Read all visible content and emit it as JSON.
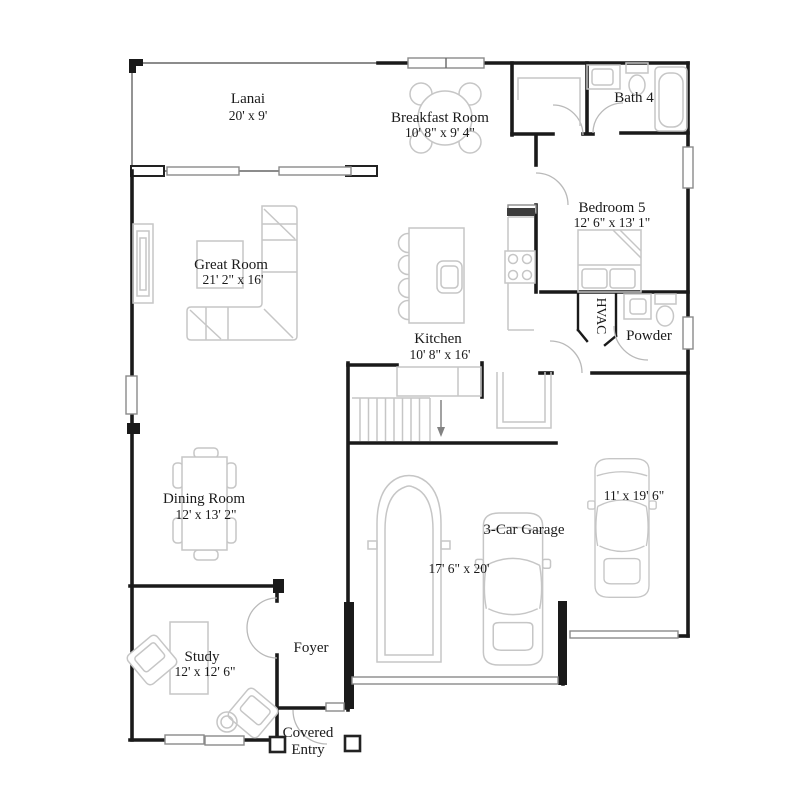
{
  "page": {
    "title": "First Floor Plan"
  },
  "colors": {
    "wall": "#1a1a1a",
    "furniture": "#c6c6c6",
    "text": "#1a1a1a",
    "background": "#ffffff"
  },
  "rooms": {
    "lanai": {
      "name": "Lanai",
      "dims": "20' x 9'"
    },
    "breakfast_room": {
      "name": "Breakfast Room",
      "dims": "10' 8\" x 9' 4\""
    },
    "bath4": {
      "name": "Bath 4"
    },
    "bedroom5": {
      "name": "Bedroom 5",
      "dims": "12' 6\" x 13' 1\""
    },
    "great_room": {
      "name": "Great Room",
      "dims": "21' 2\" x 16'"
    },
    "kitchen": {
      "name": "Kitchen",
      "dims": "10' 8\" x 16'"
    },
    "hvac": {
      "name": "HVAC"
    },
    "powder": {
      "name": "Powder"
    },
    "dining_room": {
      "name": "Dining Room",
      "dims": "12' x 13' 2\""
    },
    "garage": {
      "name": "3-Car Garage",
      "dims_main": "17' 6\" x 20'",
      "dims_right_bay": "11' x 19' 6\""
    },
    "study": {
      "name": "Study",
      "dims": "12' x 12' 6\""
    },
    "foyer": {
      "name": "Foyer"
    },
    "covered_entry": {
      "lines": [
        "Covered",
        "Entry"
      ]
    }
  }
}
